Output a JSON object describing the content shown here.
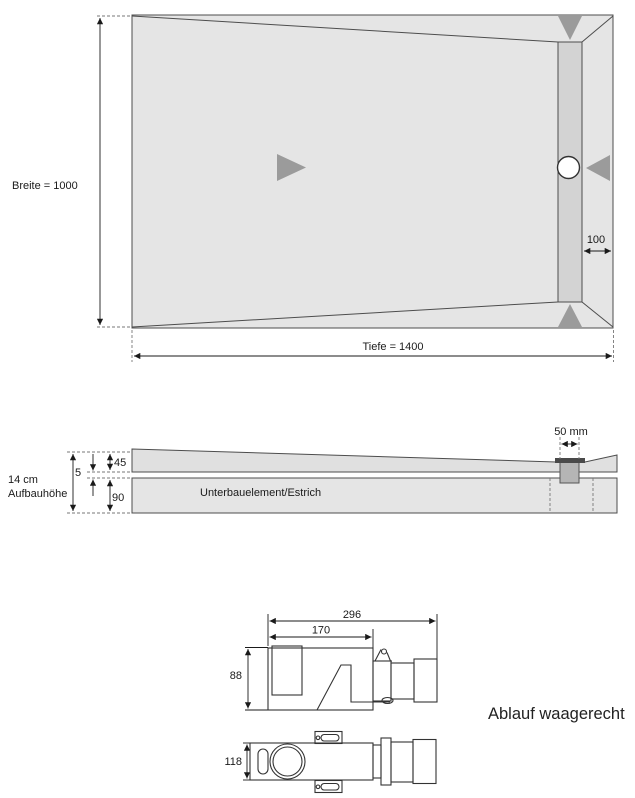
{
  "plan_view": {
    "breite_label": "Breite = 1000",
    "tiefe_label": "Tiefe = 1400",
    "channel_edge_distance_label": "100"
  },
  "section_view": {
    "total_height_label_line1": "14 cm",
    "total_height_label_line2": "Aufbauhöhe",
    "element_thickness_label": "45",
    "adhesive_gap_label": "5",
    "substrate_thickness_label": "90",
    "channel_width_label": "50 mm",
    "substrate_label": "Unterbauelement/Estrich"
  },
  "drain_views": {
    "caption": "Ablauf waagerecht",
    "overall_length_label": "296",
    "body_length_label": "170",
    "side_height_label": "88",
    "plan_width_label": "118"
  },
  "colors": {
    "surface_fill": "#e5e5e5",
    "channel_fill": "#d3d3d3",
    "slope_arrow": "#9b9b9b",
    "drain_body_fill": "#b5b5b5",
    "grate_fill": "#4a4a4a",
    "outline": "#4d4d4d",
    "dimension": "#1a1a1a"
  }
}
